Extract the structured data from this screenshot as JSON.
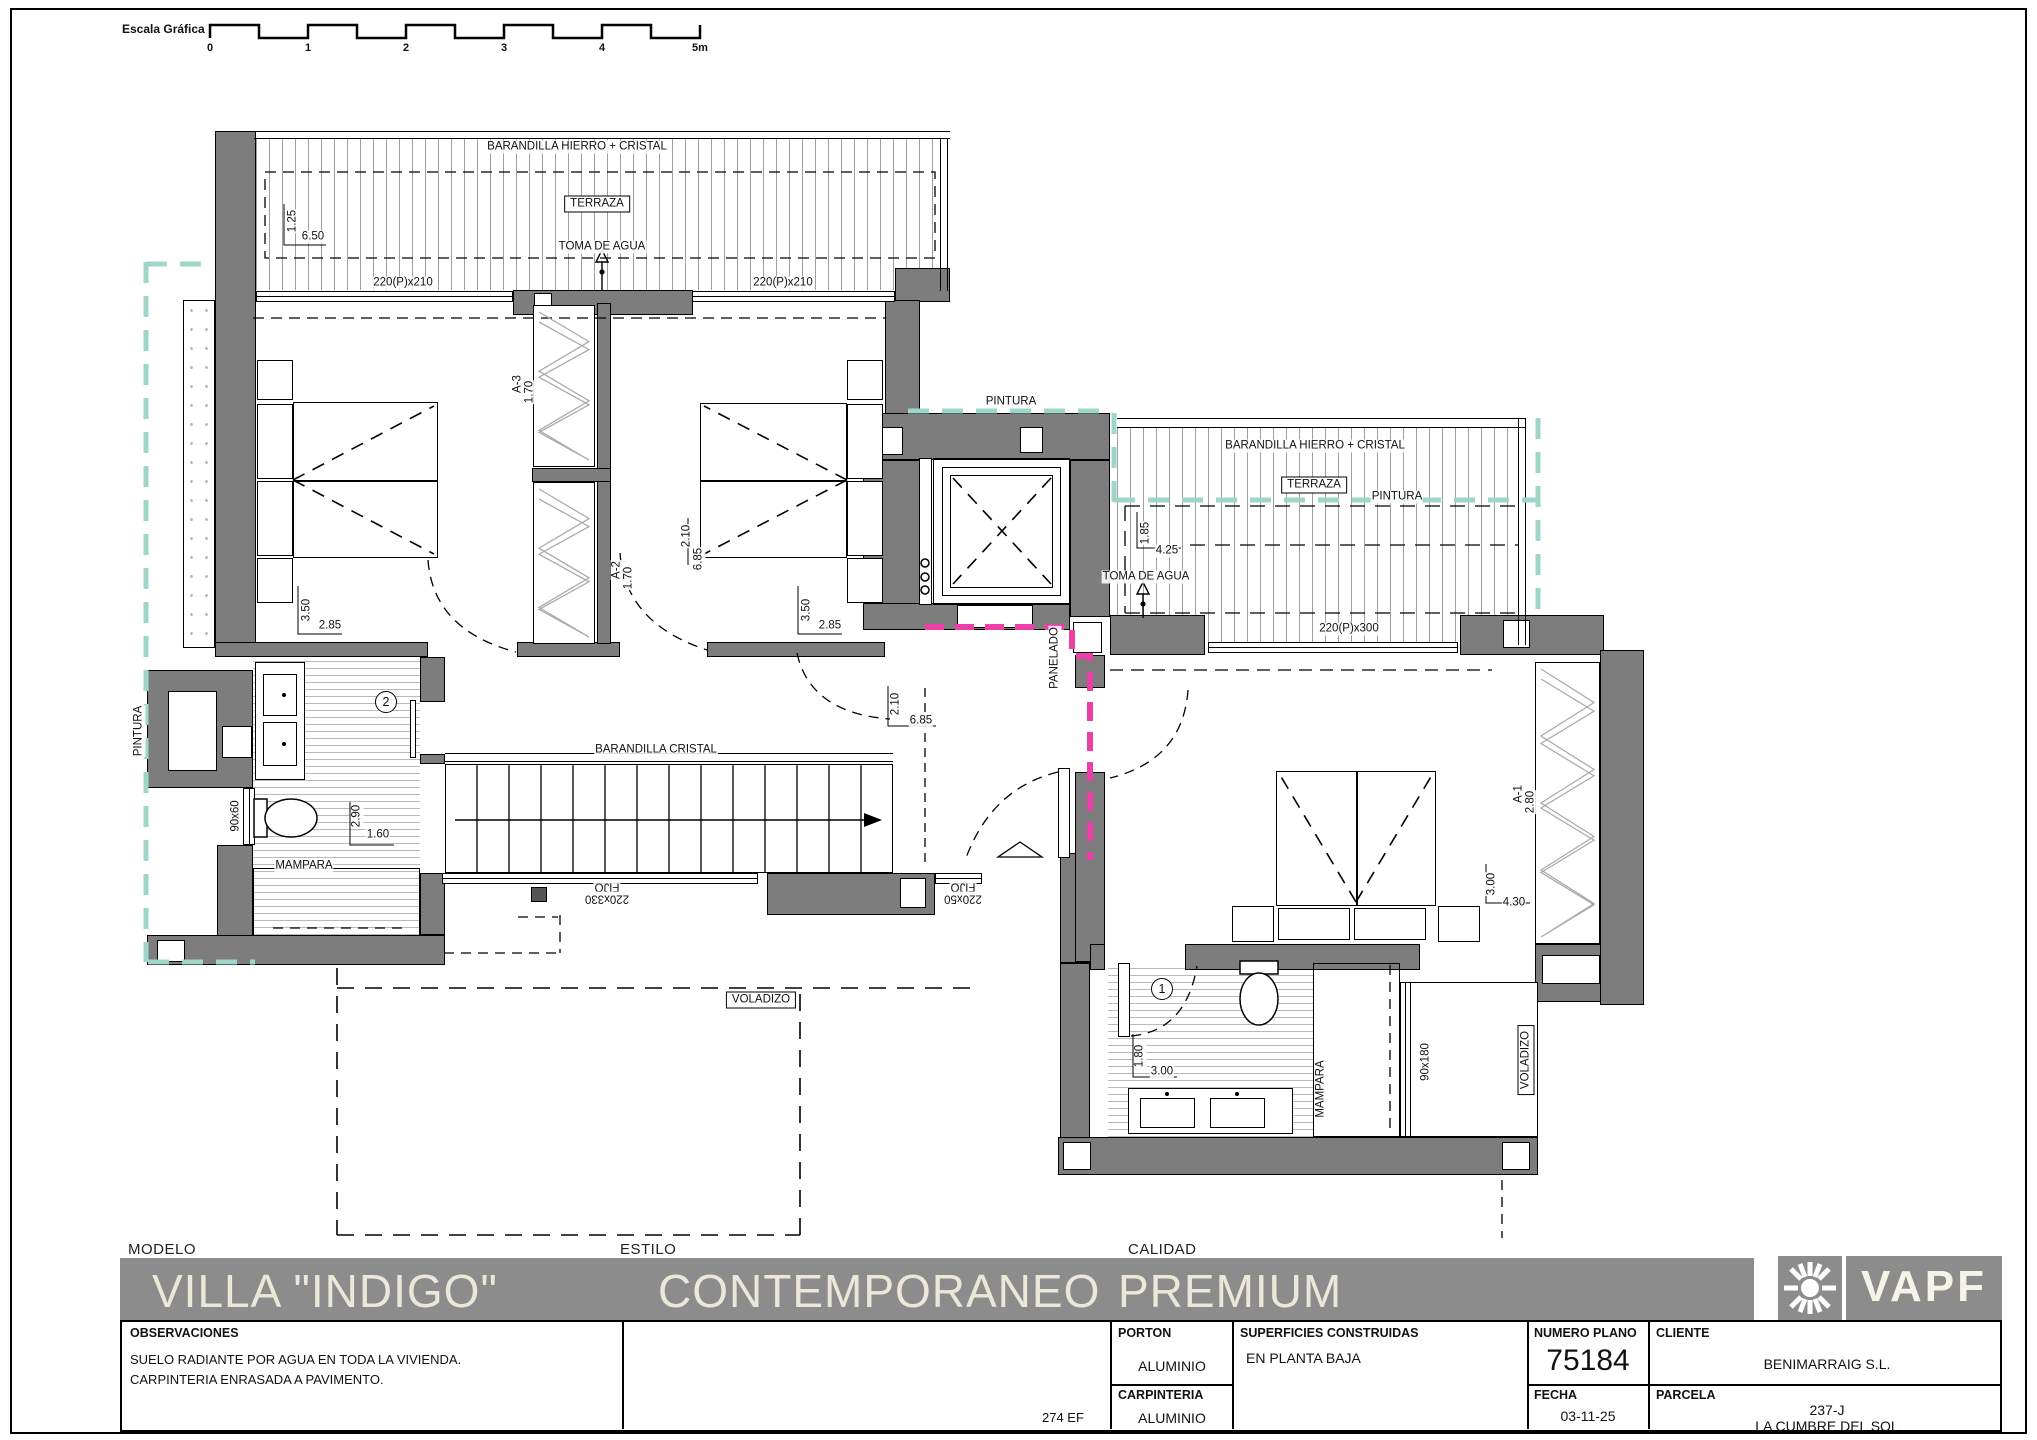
{
  "colors": {
    "wall": "#7d7d7d",
    "accent_teal": "#9ed7c9",
    "accent_magenta": "#ee3fa8",
    "titlebar": "#8c8c8c",
    "title_text": "#ece8d9"
  },
  "scale_bar": {
    "label": "Escala Gráfica",
    "ticks": [
      "0",
      "1",
      "2",
      "3",
      "4",
      "5m"
    ]
  },
  "plan_labels": [
    {
      "name": "label-barandilla-terraza-norte",
      "text": "BARANDILLA HIERRO + CRISTAL",
      "x": 577,
      "y": 147
    },
    {
      "name": "label-terraza-norte",
      "text": "TERRAZA",
      "x": 597,
      "y": 204,
      "cls": "boxed"
    },
    {
      "name": "label-toma-agua-norte",
      "text": "TOMA DE AGUA",
      "x": 602,
      "y": 247
    },
    {
      "name": "dim-terraza-norte-ancho",
      "text": "1.25",
      "x": 293,
      "y": 221,
      "rot": -90
    },
    {
      "name": "dim-terraza-norte-largo",
      "text": "6.50",
      "x": 313,
      "y": 237
    },
    {
      "name": "label-ventana-220x210-izq",
      "text": "220(P)x210",
      "x": 403,
      "y": 283
    },
    {
      "name": "label-ventana-220x210-der",
      "text": "220(P)x210",
      "x": 783,
      "y": 283
    },
    {
      "name": "label-armario-a3",
      "text": "A-3",
      "x": 518,
      "y": 384,
      "rot": -90
    },
    {
      "name": "dim-armario-a3",
      "text": "1.70",
      "x": 530,
      "y": 392,
      "rot": -90
    },
    {
      "name": "label-armario-a2",
      "text": "A-2",
      "x": 617,
      "y": 570,
      "rot": -90
    },
    {
      "name": "dim-armario-a2",
      "text": "1.70",
      "x": 629,
      "y": 578,
      "rot": -90
    },
    {
      "name": "dim-dormitorio2-ancho",
      "text": "3.50",
      "x": 307,
      "y": 610,
      "rot": -90
    },
    {
      "name": "dim-dormitorio2-largo",
      "text": "2.85",
      "x": 330,
      "y": 626
    },
    {
      "name": "dim-dormitorio3-ancho",
      "text": "3.50",
      "x": 807,
      "y": 610,
      "rot": -90
    },
    {
      "name": "dim-dormitorio3-largo",
      "text": "2.85",
      "x": 830,
      "y": 626
    },
    {
      "name": "label-pintura-oeste",
      "text": "PINTURA",
      "x": 139,
      "y": 731,
      "rot": -90
    },
    {
      "name": "badge-bano-2",
      "text": "2",
      "x": 386,
      "y": 702,
      "cls": "circ"
    },
    {
      "name": "label-ventana-90x60",
      "text": "90x60",
      "x": 236,
      "y": 816,
      "rot": -90
    },
    {
      "name": "dim-bano2-ancho",
      "text": "2.90",
      "x": 357,
      "y": 816,
      "rot": -90
    },
    {
      "name": "dim-bano2-largo",
      "text": "1.60",
      "x": 378,
      "y": 835
    },
    {
      "name": "label-mampara-bano2",
      "text": "MAMPARA",
      "x": 304,
      "y": 866
    },
    {
      "name": "label-barandilla-escalera",
      "text": "BARANDILLA CRISTAL",
      "x": 656,
      "y": 750
    },
    {
      "name": "label-fijo-330-a",
      "text": "FIJO",
      "x": 607,
      "y": 886,
      "rot": 180
    },
    {
      "name": "label-fijo-330-b",
      "text": "220x330",
      "x": 607,
      "y": 898,
      "rot": 180
    },
    {
      "name": "label-fijo-50-a",
      "text": "FIJO",
      "x": 963,
      "y": 886,
      "rot": 180
    },
    {
      "name": "label-fijo-50-b",
      "text": "220x50",
      "x": 963,
      "y": 898,
      "rot": 180
    },
    {
      "name": "label-voladizo-sur",
      "text": "VOLADIZO",
      "x": 761,
      "y": 1000,
      "cls": "boxed"
    },
    {
      "name": "dim-pasillo-ancho",
      "text": "2.10",
      "x": 687,
      "y": 536,
      "rot": -90
    },
    {
      "name": "dim-pasillo-largo",
      "text": "6.85",
      "x": 699,
      "y": 559,
      "rot": -90
    },
    {
      "name": "dim-distribuidor-ancho",
      "text": "2.10",
      "x": 896,
      "y": 704,
      "rot": -90
    },
    {
      "name": "dim-distribuidor-largo",
      "text": "6.85",
      "x": 921,
      "y": 721
    },
    {
      "name": "label-pintura-ascensor",
      "text": "PINTURA",
      "x": 1011,
      "y": 402
    },
    {
      "name": "label-panelado",
      "text": "PANELADO",
      "x": 1055,
      "y": 658,
      "rot": -90
    },
    {
      "name": "label-barandilla-terraza-este",
      "text": "BARANDILLA HIERRO + CRISTAL",
      "x": 1315,
      "y": 446
    },
    {
      "name": "label-terraza-este",
      "text": "TERRAZA",
      "x": 1314,
      "y": 485,
      "cls": "boxed"
    },
    {
      "name": "label-pintura-terraza-este",
      "text": "PINTURA",
      "x": 1397,
      "y": 497
    },
    {
      "name": "dim-terraza-este-ancho",
      "text": "1.85",
      "x": 1146,
      "y": 533,
      "rot": -90
    },
    {
      "name": "dim-terraza-este-largo",
      "text": "4.25",
      "x": 1167,
      "y": 551
    },
    {
      "name": "label-toma-agua-este",
      "text": "TOMA DE AGUA",
      "x": 1146,
      "y": 577
    },
    {
      "name": "label-ventana-220x300",
      "text": "220(P)x300",
      "x": 1349,
      "y": 629
    },
    {
      "name": "label-armario-a1",
      "text": "A-1",
      "x": 1519,
      "y": 794,
      "rot": -90
    },
    {
      "name": "dim-armario-a1",
      "text": "2.80",
      "x": 1531,
      "y": 802,
      "rot": -90
    },
    {
      "name": "dim-dormitorio1-ancho",
      "text": "3.00",
      "x": 1492,
      "y": 884,
      "rot": -90
    },
    {
      "name": "dim-dormitorio1-largo",
      "text": "4.30",
      "x": 1514,
      "y": 903
    },
    {
      "name": "badge-bano-1",
      "text": "1",
      "x": 1162,
      "y": 989,
      "cls": "circ"
    },
    {
      "name": "dim-bano1-ancho",
      "text": "1.80",
      "x": 1140,
      "y": 1056,
      "rot": -90
    },
    {
      "name": "dim-bano1-largo",
      "text": "3.00",
      "x": 1162,
      "y": 1072
    },
    {
      "name": "label-mampara-bano1",
      "text": "MAMPARA",
      "x": 1321,
      "y": 1089,
      "rot": -90
    },
    {
      "name": "label-ventana-90x180",
      "text": "90x180",
      "x": 1426,
      "y": 1062,
      "rot": -90
    },
    {
      "name": "label-voladizo-este",
      "text": "VOLADIZO",
      "x": 1526,
      "y": 1060,
      "rot": -90,
      "cls": "boxed"
    }
  ],
  "title_block": {
    "modelo_label": "MODELO",
    "modelo_value": "VILLA \"INDIGO\"",
    "estilo_label": "ESTILO",
    "estilo_value": "CONTEMPORANEO",
    "calidad_label": "CALIDAD",
    "calidad_value": "PREMIUM",
    "logo_text": "VAPF"
  },
  "info_table": {
    "observaciones_label": "OBSERVACIONES",
    "obs_line1": "SUELO RADIANTE POR AGUA EN TODA LA VIVIENDA.",
    "obs_line2": "CARPINTERIA ENRASADA A PAVIMENTO.",
    "ref_code": "274 EF",
    "porton_label": "PORTON",
    "porton_value": "ALUMINIO",
    "carpinteria_label": "CARPINTERIA",
    "carpinteria_value": "ALUMINIO",
    "superficies_label": "SUPERFICIES CONSTRUIDAS",
    "superficies_value": "EN PLANTA BAJA",
    "numero_plano_label": "NUMERO PLANO",
    "numero_plano_value": "75184",
    "fecha_label": "FECHA",
    "fecha_value": "03-11-25",
    "cliente_label": "CLIENTE",
    "cliente_value": "BENIMARRAIG S.L.",
    "parcela_label": "PARCELA",
    "parcela_value_line1": "237-J",
    "parcela_value_line2": "LA CUMBRE DEL SOL"
  }
}
